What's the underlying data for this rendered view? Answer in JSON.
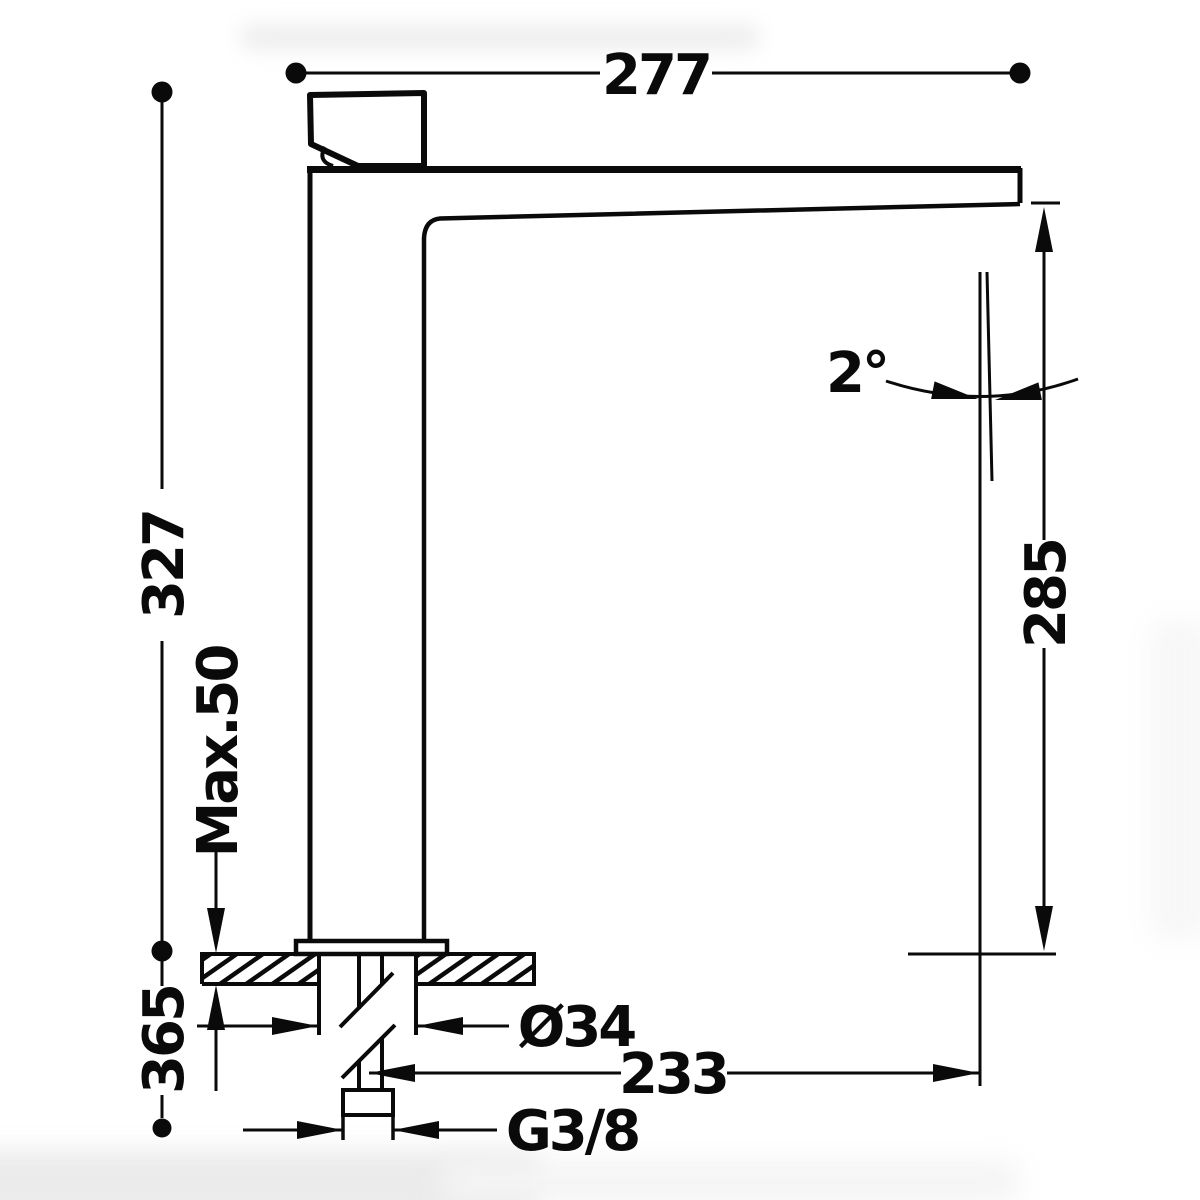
{
  "page": {
    "background_color": "#ffffff",
    "line_color": "#0a0a0a"
  },
  "drawing": {
    "type": "technical-dimension-drawing",
    "view": "side-elevation-of-tall-single-lever-basin-mixer",
    "labels": {
      "reach_overall": "277",
      "height_above_deck": "327",
      "max_deck": "Max.50",
      "below_deck": "365",
      "outlet_height": "285",
      "angle": "2°",
      "base_diameter": "Ø34",
      "outlet_reach": "233",
      "thread": "G3/8"
    }
  }
}
